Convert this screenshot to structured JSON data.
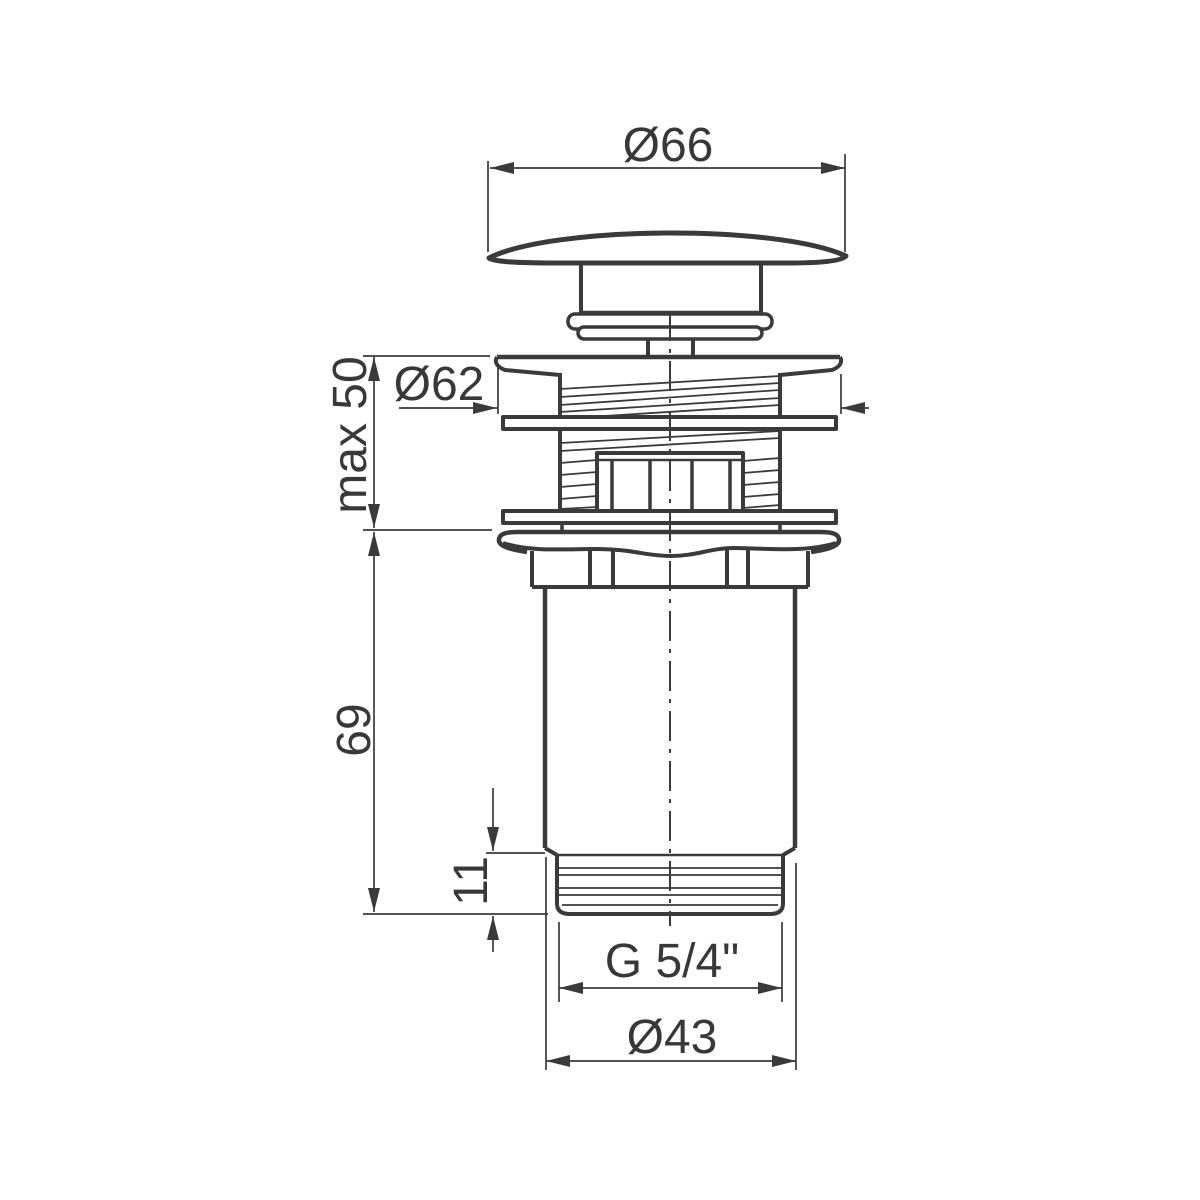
{
  "drawing": {
    "type": "technical-dimension-drawing",
    "subject": "click-clack basin waste valve, side view",
    "background_color": "#ffffff",
    "line_color": "#3a3a3a",
    "labels": {
      "cap_diameter": "Ø66",
      "flange_diameter": "Ø62",
      "clamp_range": "max 50",
      "body_length": "69",
      "thread_length": "11",
      "thread_size": "G 5/4\"",
      "body_diameter": "Ø43"
    }
  }
}
